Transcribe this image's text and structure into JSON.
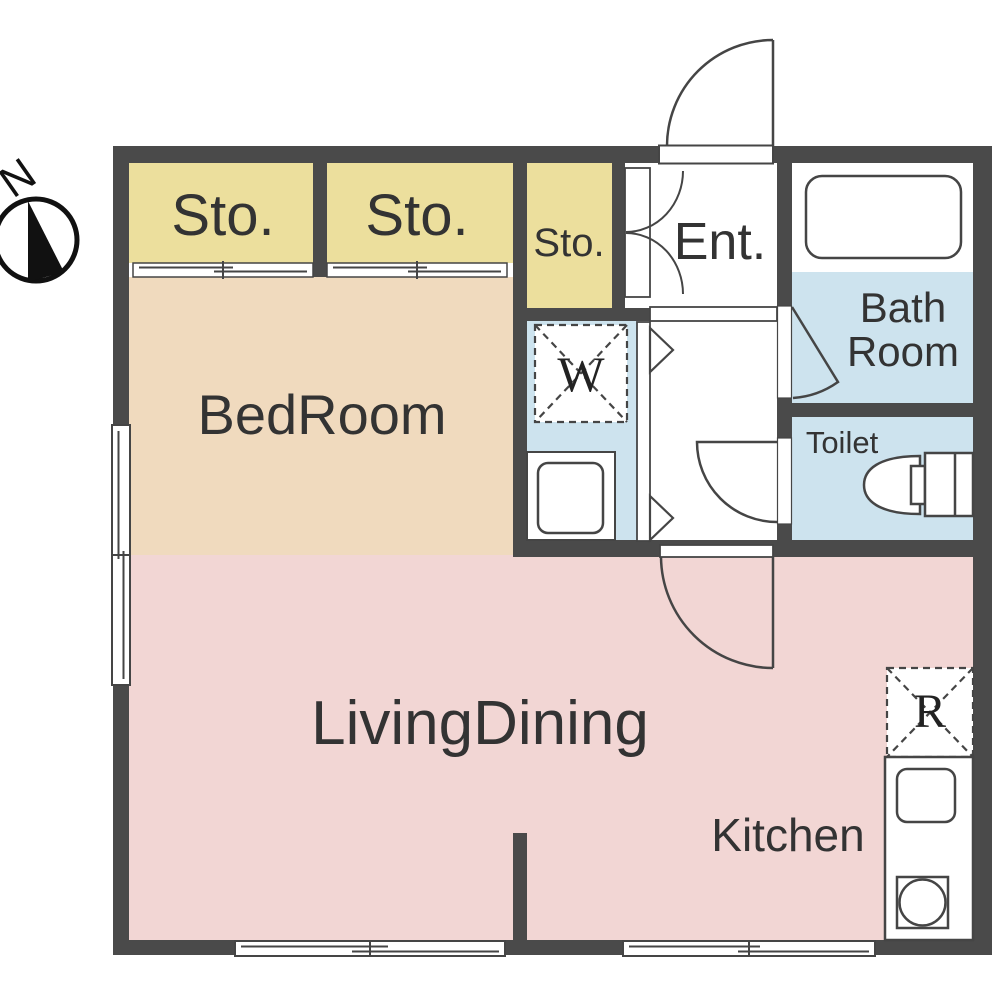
{
  "compass": {
    "label": "N"
  },
  "colors": {
    "wall": "#4a4a4a",
    "storage": "#ecdf9d",
    "bedroom": "#f0dabe",
    "living": "#f2d6d4",
    "wet": "#cde3ee",
    "white": "#ffffff"
  },
  "rooms": {
    "storage1": "Sto.",
    "storage2": "Sto.",
    "storage3": "Sto.",
    "entrance": "Ent.",
    "bath_line1": "Bath",
    "bath_line2": "Room",
    "washer": "W",
    "toilet": "Toilet",
    "bedroom": "BedRoom",
    "living_dining": "LivingDining",
    "kitchen": "Kitchen",
    "refrigerator": "R"
  }
}
